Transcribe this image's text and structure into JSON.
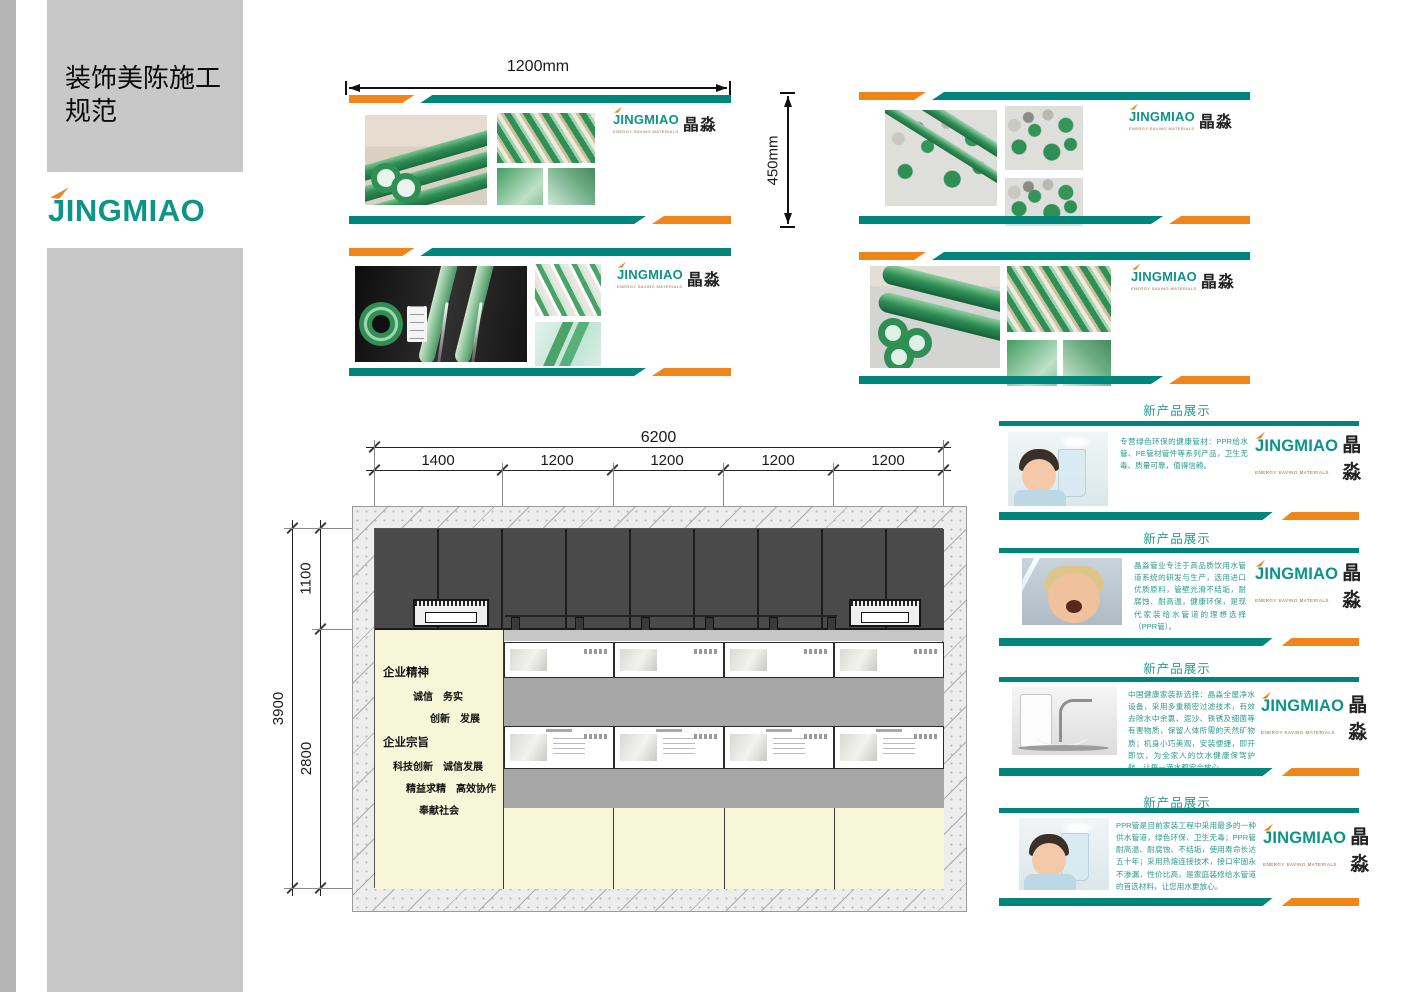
{
  "sidebar": {
    "title_line1": "装饰美陈施工",
    "title_line2": "规范"
  },
  "brand": {
    "name": "JINGMIAO",
    "cn": "晶淼",
    "tagline": "ENERGY SAVING MATERIALS"
  },
  "colors": {
    "teal": "#00857A",
    "orange": "#F08519",
    "dark_band": "#4A4A4A",
    "cream": "#F5F7D8"
  },
  "dims": {
    "banner_width": "1200mm",
    "banner_height": "450mm",
    "total_width": "6200",
    "segments": [
      "1400",
      "1200",
      "1200",
      "1200",
      "1200"
    ],
    "v_top": "1100",
    "v_total": "3900",
    "v_bottom": "2800"
  },
  "wall": {
    "spirit_heading": "企业精神",
    "spirit_line1": "诚信　务实",
    "spirit_line2": "创新　发展",
    "purpose_heading": "企业宗旨",
    "purpose_line1": "科技创新　诚信发展",
    "purpose_line2": "精益求精　高效协作",
    "purpose_line3": "奉献社会"
  },
  "cards": [
    {
      "title": "新产品展示",
      "text": "专营绿色环保的健康管材：PPR给水管、PE管材管件等系列产品，卫生无毒、质量可靠，值得信赖。"
    },
    {
      "title": "新产品展示",
      "text": "晶淼管业专注于高品质饮用水管道系统的研发与生产，选用进口优质原料，管壁光滑不结垢，耐腐蚀、耐高温，健康环保，是现代家装给水管道的理想选择（PPR管）。"
    },
    {
      "title": "新产品展示",
      "text": "中国健康家装新选择：晶淼全屋净水设备，采用多重精密过滤技术，有效去除水中余氯、泥沙、铁锈及细菌等有害物质，保留人体所需的天然矿物质；机身小巧美观，安装便捷，即开即饮，为全家人的饮水健康保驾护航，让每一滴水都安全放心。"
    },
    {
      "title": "新产品展示",
      "text": "PPR管是目前家装工程中采用最多的一种供水管道，绿色环保、卫生无毒；PPR管耐高温、耐腐蚀、不结垢，使用寿命长达五十年；采用热熔连接技术，接口牢固永不渗漏，性价比高，是家庭装修给水管道的首选材料，让您用水更放心。"
    }
  ]
}
